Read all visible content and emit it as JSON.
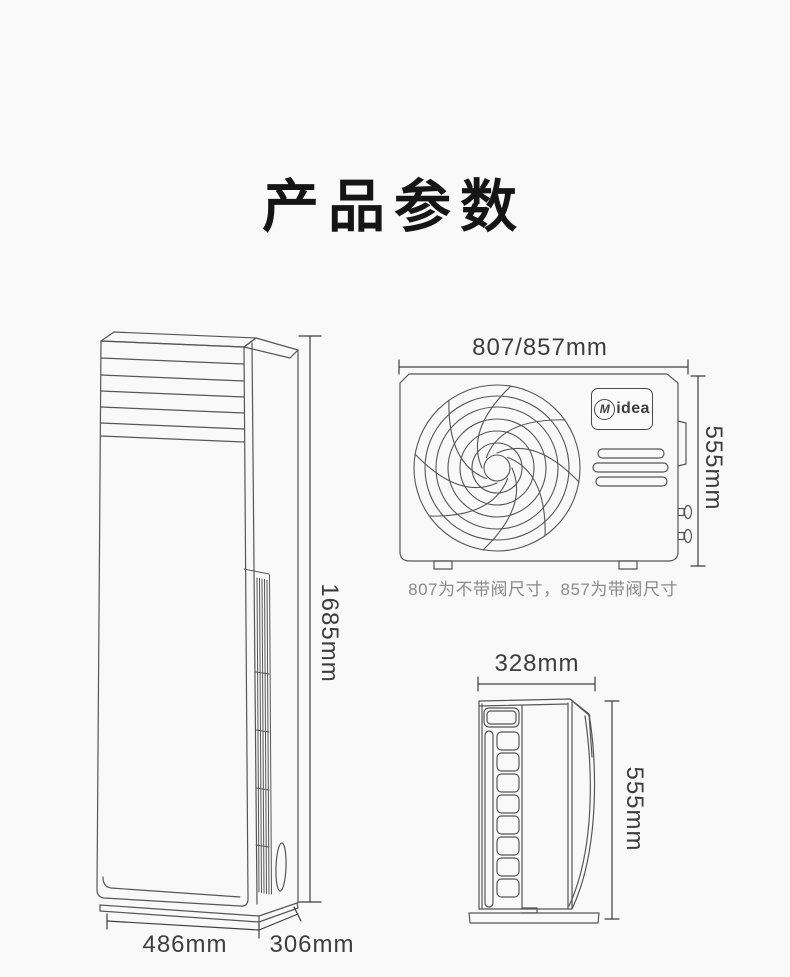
{
  "title": "产品参数",
  "indoor": {
    "height": "1685mm",
    "width": "486mm",
    "depth": "306mm"
  },
  "outdoor_front": {
    "width": "807/857mm",
    "height": "555mm",
    "note": "807为不带阀尺寸，857为带阀尺寸",
    "brand_initial": "M",
    "brand_rest": "idea"
  },
  "outdoor_side": {
    "width": "328mm",
    "height": "555mm"
  },
  "colors": {
    "background": "#f9f9f9",
    "line_art": "#565656",
    "dimension_text": "#3d3d3d",
    "note_text": "#8a8a8a",
    "title_text": "#151515"
  }
}
